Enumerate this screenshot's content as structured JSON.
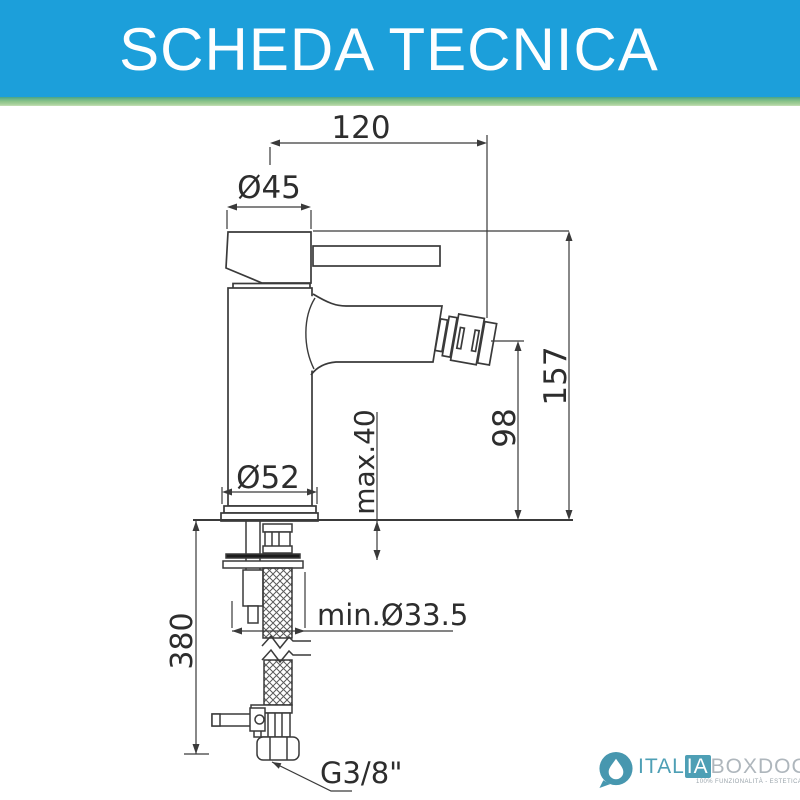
{
  "header": {
    "title": "SCHEDA TECNICA"
  },
  "drawing": {
    "dims": {
      "projection": "120",
      "cap_diameter": "Ø45",
      "total_height": "157",
      "spout_height": "98",
      "deck_max": "max.40",
      "base_diameter": "Ø52",
      "hose_length": "380",
      "hole_min": "min.Ø33.5",
      "connection": "G3/8\""
    }
  },
  "logo": {
    "brand_first": "ITAL",
    "brand_highlight": "IA",
    "brand_rest": "BOXDOCCIA",
    "tagline": "100% FUNZIONALITÀ - ESTETICA - PRATICITÀ"
  },
  "colors": {
    "header_blue": "#1c9fda",
    "strip_green": "#8cc48a",
    "logo_teal": "#4e9fb5",
    "line_dark": "#3a3a3a"
  }
}
